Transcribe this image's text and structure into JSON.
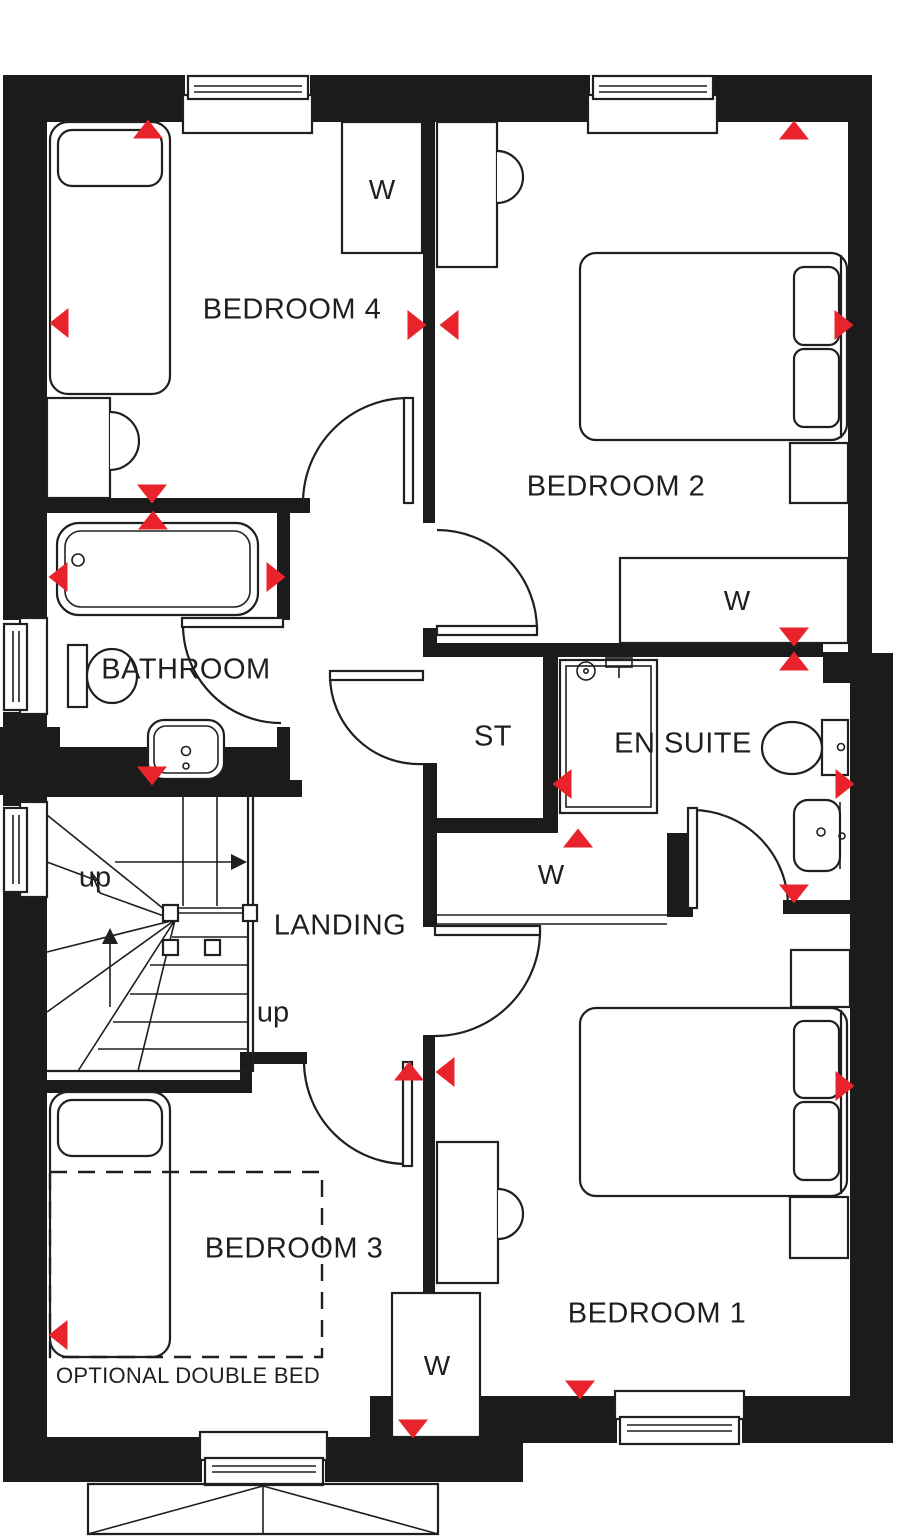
{
  "colors": {
    "wall": "#1b1b1b",
    "line": "#1f1f1f",
    "marker_red": "#e8232b",
    "background": "#ffffff"
  },
  "rooms": [
    {
      "id": "bedroom-4",
      "label": "BEDROOM 4"
    },
    {
      "id": "bedroom-2",
      "label": "BEDROOM 2"
    },
    {
      "id": "bathroom",
      "label": "BATHROOM"
    },
    {
      "id": "store",
      "label": "ST"
    },
    {
      "id": "en-suite",
      "label": "EN SUITE"
    },
    {
      "id": "landing",
      "label": "LANDING"
    },
    {
      "id": "bedroom-3",
      "label": "BEDROOM 3"
    },
    {
      "id": "bedroom-1",
      "label": "BEDROOM 1"
    }
  ],
  "wardrobes": [
    {
      "id": "bedroom-4-wardrobe",
      "label": "W"
    },
    {
      "id": "bedroom-2-wardrobe",
      "label": "W"
    },
    {
      "id": "landing-cupboard",
      "label": "W"
    },
    {
      "id": "bedroom-1-wardrobe",
      "label": "W"
    }
  ],
  "stairs": {
    "up_label_top": "up",
    "up_label_bottom": "up"
  },
  "annotations": {
    "optional_double_bed": "OPTIONAL DOUBLE BED"
  },
  "markers": [
    {
      "x": 148,
      "y": 129,
      "dir": "up"
    },
    {
      "x": 59,
      "y": 323,
      "dir": "left"
    },
    {
      "x": 417,
      "y": 325,
      "dir": "right"
    },
    {
      "x": 449,
      "y": 325,
      "dir": "left"
    },
    {
      "x": 152,
      "y": 494,
      "dir": "down"
    },
    {
      "x": 153,
      "y": 520,
      "dir": "up"
    },
    {
      "x": 58,
      "y": 577,
      "dir": "left"
    },
    {
      "x": 276,
      "y": 577,
      "dir": "right"
    },
    {
      "x": 152,
      "y": 776,
      "dir": "down"
    },
    {
      "x": 794,
      "y": 130,
      "dir": "up"
    },
    {
      "x": 844,
      "y": 325,
      "dir": "right"
    },
    {
      "x": 794,
      "y": 637,
      "dir": "down"
    },
    {
      "x": 794,
      "y": 661,
      "dir": "up"
    },
    {
      "x": 562,
      "y": 784,
      "dir": "left"
    },
    {
      "x": 578,
      "y": 838,
      "dir": "up"
    },
    {
      "x": 794,
      "y": 894,
      "dir": "down"
    },
    {
      "x": 845,
      "y": 784,
      "dir": "right"
    },
    {
      "x": 409,
      "y": 1071,
      "dir": "up"
    },
    {
      "x": 445,
      "y": 1072,
      "dir": "left"
    },
    {
      "x": 58,
      "y": 1335,
      "dir": "left"
    },
    {
      "x": 413,
      "y": 1429,
      "dir": "down"
    },
    {
      "x": 580,
      "y": 1390,
      "dir": "down"
    },
    {
      "x": 845,
      "y": 1086,
      "dir": "right"
    }
  ]
}
